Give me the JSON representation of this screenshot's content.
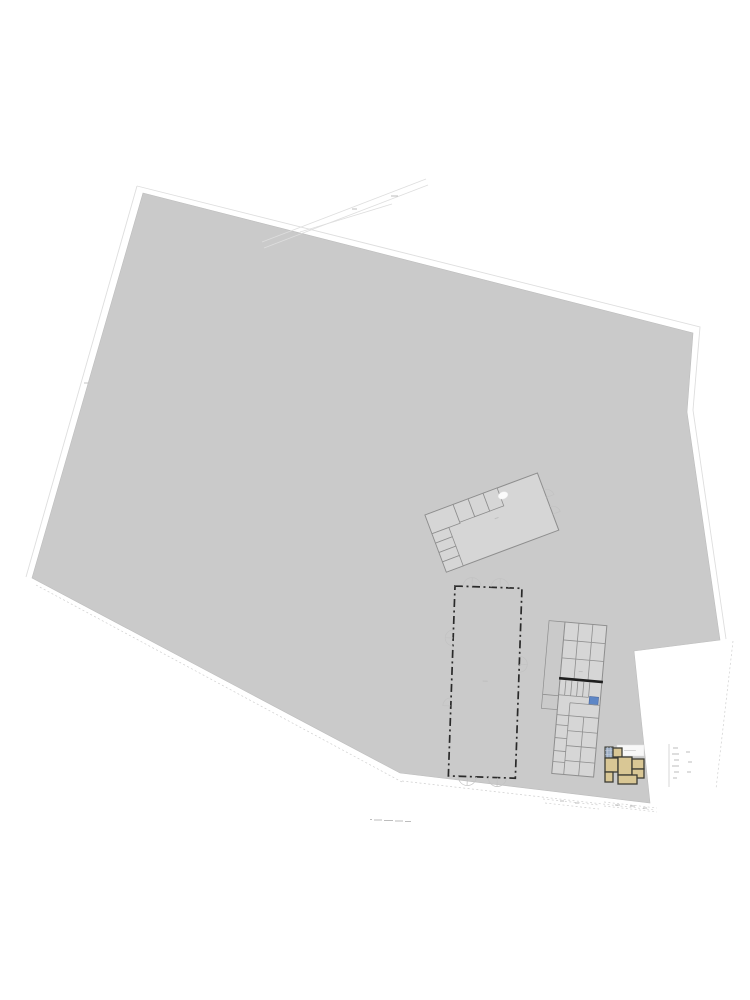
{
  "document": {
    "kind": "cadastral site plan with building floor plans",
    "visible_text": "none legible (only sub-pixel annotation marks)"
  },
  "colors": {
    "page_bg": "#ffffff",
    "parcel_fill": "#cacaca",
    "parcel_stroke": "#bdbdbd",
    "building_fill": "#d6d6d6",
    "building_stroke": "#8e8e8e",
    "dark_wall": "#1f1f1f",
    "dashed_outline": "#2a2a2a",
    "door_arc": "#c2c2c2",
    "faint_line": "#dedede",
    "dotted_line": "#cfcfcf",
    "tan_room": "#d9c795",
    "house_wall": "#3c3c34",
    "tiled_room": "#9fb0c6",
    "tile_grid": "#ccd4e0",
    "water_blue": "#5d86c6",
    "label_bg": "#f8f8f8",
    "mark": "#bdbdbd"
  },
  "parcel": {
    "points": "143,193 693,333 687,412 720,640 634,651 650,803 400,773 32,578"
  },
  "outer_boundary": {
    "left": "137,186 26,577",
    "top_right": "137,186 700,327 693,410 726,639",
    "bottom_left_dotted": "36,585 402,782",
    "bottom_mid_dotted": "402,781 655,810",
    "right_dotted": "733,641 716,789"
  },
  "road_lines": {
    "line1": "262,242 426,179",
    "line2": "264,248 428,185",
    "line3": "300,232 392,204"
  },
  "buildings": {
    "barn": {
      "transform": "translate(425,515) rotate(-20.5)"
    },
    "warehouse": {
      "transform": "translate(455,586) rotate(2)"
    },
    "stable": {
      "transform": "translate(565,622) rotate(5)"
    },
    "house": {
      "transform": "translate(603,745)"
    }
  }
}
